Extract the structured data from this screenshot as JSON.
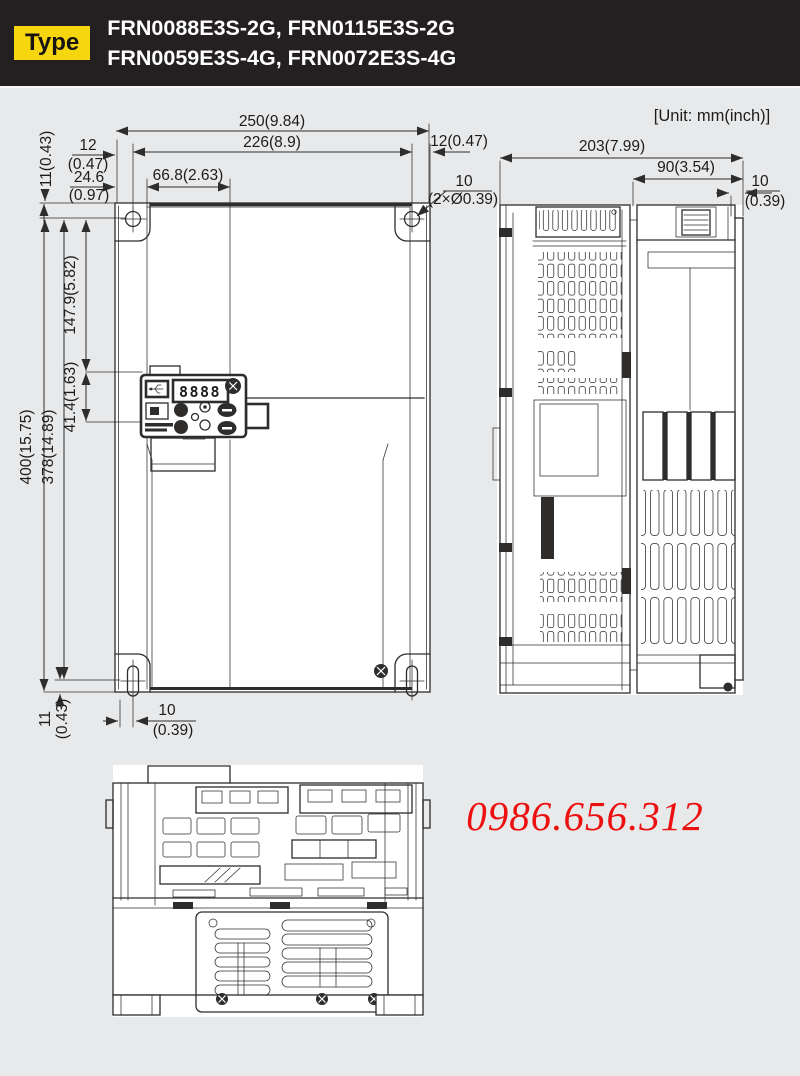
{
  "header": {
    "badge_label": "Type",
    "models_line1": "FRN0088E3S-2G, FRN0115E3S-2G",
    "models_line2": "FRN0059E3S-4G, FRN0072E3S-4G"
  },
  "unit_label": "[Unit: mm(inch)]",
  "watermark_phone": "0986.656.312",
  "colors": {
    "header_bg": "#242021",
    "badge_bg": "#f6d60f",
    "page_bg": "#e8e9ea",
    "line": "#2e2d2c",
    "watermark": "#ed1010"
  },
  "front_view": {
    "keypad_display": "8888",
    "dims": {
      "overall_width": "250(9.84)",
      "mounting_hole_span_width": "226(8.9)",
      "right_hole_offset": "12(0.47)",
      "left_hole_offset_mm": "12",
      "left_hole_offset_inch": "(0.47)",
      "top_hole_offset": "11(0.43)",
      "keypad_left_offset_mm": "24.6",
      "keypad_left_offset_inch": "(0.97)",
      "keypad_width_offset": "66.8(2.63)",
      "hole_size_mm": "10",
      "hole_size_note": "(2×Ø0.39)",
      "overall_height": "400(15.75)",
      "mounting_hole_span_height": "378(14.89)",
      "keypad_top_offset": "147.9(5.82)",
      "keypad_height": "41.4(1.63)",
      "bottom_hole_offset_mm": "11",
      "bottom_hole_offset_inch": "(0.43)",
      "bottom_slot_offset_mm": "10",
      "bottom_slot_offset_inch": "(0.39)"
    }
  },
  "side_view": {
    "dims": {
      "overall_depth": "203(7.99)",
      "body_depth": "90(3.54)",
      "front_cover_depth_mm": "10",
      "front_cover_depth_inch": "(0.39)"
    }
  }
}
